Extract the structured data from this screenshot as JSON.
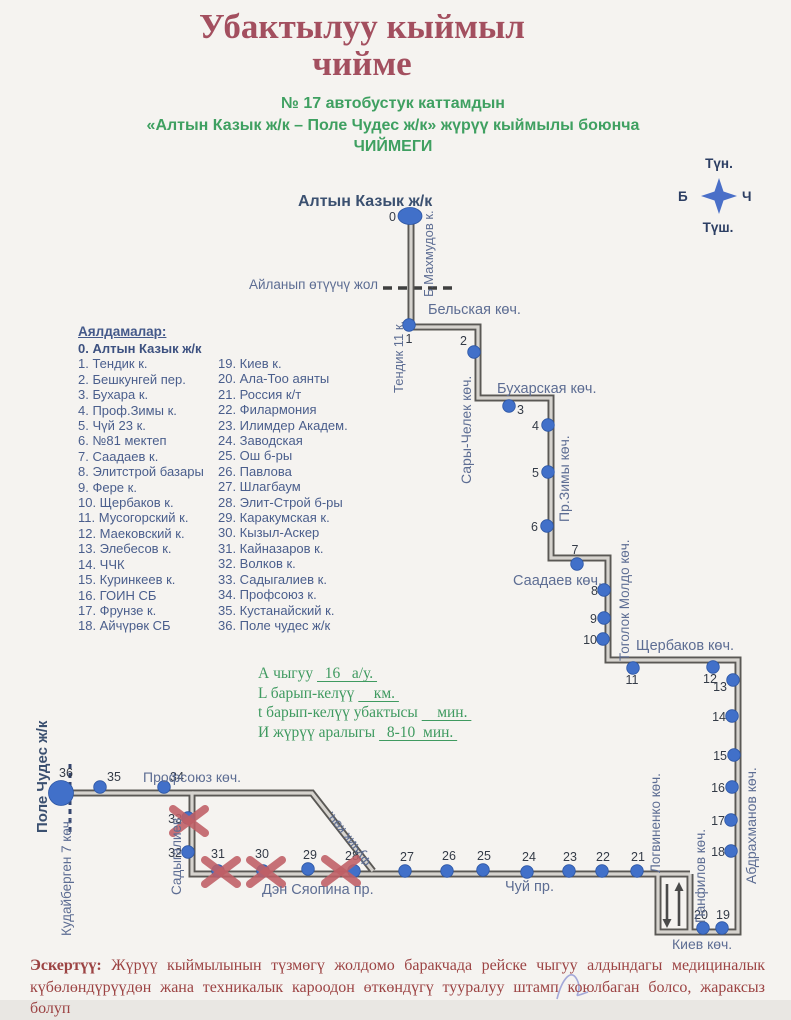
{
  "title": {
    "line1": "Убактылуу кыймыл",
    "line2": "чийме"
  },
  "subtitle": {
    "line1": "№ 17  автобустук каттамдын",
    "line2": "«Алтын Казык ж/к  – Поле Чудес ж/к» жүрүү кыймылы боюнча",
    "line3": "ЧИЙМЕГИ"
  },
  "compass": {
    "north": "Түн.",
    "south": "Түш.",
    "west": "Б",
    "east": "Ч",
    "star_color": "#4a6fc8"
  },
  "legend": {
    "heading": "Аялдамалар:",
    "col1": [
      "0. Алтын Казык ж/к",
      "1. Тендик к.",
      "2. Бешкунгей пер.",
      "3. Бухара к.",
      "4. Проф.Зимы к.",
      "5. Чүй 23 к.",
      "6. №81 мектеп",
      "7. Саадаев к.",
      "8. Элитстрой базары",
      "9. Фере к.",
      "10. Щербаков к.",
      "11. Мусогорский к.",
      "12. Маековский к.",
      "13. Элебесов к.",
      "14. ЧЧК",
      "15. Куринкеев к.",
      "16. ГОИН СБ",
      "17. Фрунзе к.",
      "18. Айчүрөк СБ"
    ],
    "col2": [
      "19. Киев к.",
      "20. Ала-Тоо аянты",
      "21. Россия к/т",
      "22. Филармония",
      "23. Илимдер Академ.",
      "24. Заводская",
      "25. Ош б-ры",
      "26. Павлова",
      "27. Шлагбаум",
      "28. Элит-Строй б-ры",
      "29. Каракумская к.",
      "30. Кызыл-Аскер",
      "31. Кайназаров к.",
      "32. Волков к.",
      "33. Садыгалиев к.",
      "34. Профсоюз к.",
      "35. Кустанайский к.",
      "36. Поле чудес ж/к"
    ]
  },
  "stats": {
    "lines": [
      {
        "parts": [
          {
            "t": "А чыгуу "
          },
          {
            "t": "  16   а/у. ",
            "u": true
          }
        ]
      },
      {
        "parts": [
          {
            "t": "L барып-келүү "
          },
          {
            "t": "    км. ",
            "u": true
          }
        ]
      },
      {
        "parts": [
          {
            "t": "t барып-келүү убактысы "
          },
          {
            "t": "    мин. ",
            "u": true
          }
        ]
      },
      {
        "parts": [
          {
            "t": "И жүрүү аралыгы "
          },
          {
            "t": "  8-10  мин. ",
            "u": true
          }
        ]
      }
    ]
  },
  "note": {
    "label": "Эскертүү:",
    "text": "Жүрүү кыймылынын түзмөгү жолдомо баракчада рейске чыгуу алдындагы медициналык күбөлөндүрүүдөн жана техникалык кароодон өткөндүгү тууралуу штамп коюлбаган болсо, жараксыз болуп"
  },
  "map": {
    "colors": {
      "road_outer": "#5a5855",
      "road_inner": "#d6d3ce",
      "stop": "#4170c9",
      "stop_edge": "#2d56a4",
      "stop_label": "#343b47",
      "street": "#5d6d93",
      "terminal": "#3b5070",
      "xmark": "#c05f66",
      "arrow": "#4a4a4a"
    },
    "roads": [
      {
        "pts": [
          [
            411,
            213
          ],
          [
            411,
            327
          ],
          [
            478,
            327
          ],
          [
            478,
            398
          ],
          [
            551,
            398
          ],
          [
            551,
            558
          ],
          [
            608,
            558
          ],
          [
            608,
            660
          ],
          [
            738,
            660
          ],
          [
            738,
            932
          ],
          [
            658,
            932
          ],
          [
            658,
            874
          ],
          [
            192,
            874
          ],
          [
            192,
            793
          ],
          [
            61,
            793
          ]
        ]
      },
      {
        "pts": [
          [
            192,
            793
          ],
          [
            312,
            793
          ],
          [
            373,
            871
          ]
        ]
      },
      {
        "pts": [
          [
            690,
            874
          ],
          [
            690,
            932
          ]
        ]
      },
      {
        "pts": [
          [
            658,
            874
          ],
          [
            690,
            874
          ]
        ]
      }
    ],
    "dashed": [
      {
        "name": "detour-dashed-line",
        "x1": 383,
        "y1": 288,
        "x2": 452,
        "y2": 288,
        "dash": "9,6",
        "w": 3.5,
        "color": "#3f3f3f"
      },
      {
        "name": "terminal-dashed-line",
        "x1": 70,
        "y1": 764,
        "x2": 70,
        "y2": 834,
        "dash": "5,4",
        "w": 3,
        "color": "#35456e"
      }
    ],
    "arrows": [
      {
        "x": 667,
        "ytail": 884,
        "yhead": 928
      },
      {
        "x": 679,
        "ytail": 926,
        "yhead": 882
      }
    ],
    "streets": [
      {
        "name": "Алтын Казык ж/к",
        "x": 298,
        "y": 206,
        "rot": 0,
        "anchor": "start",
        "bold": true,
        "navy": true,
        "size": 16
      },
      {
        "name": "Б.Махмудов к.",
        "x": 433,
        "y": 297,
        "rot": -90,
        "anchor": "start",
        "size": 13
      },
      {
        "name": "Айланып өтүүчү жол",
        "x": 378,
        "y": 289,
        "rot": 0,
        "anchor": "end",
        "size": 13.5
      },
      {
        "name": "Тендик 11 к.",
        "x": 403,
        "y": 393,
        "rot": -90,
        "anchor": "start",
        "size": 13
      },
      {
        "name": "Бельская көч.",
        "x": 428,
        "y": 314,
        "rot": 0,
        "anchor": "start",
        "size": 14.5
      },
      {
        "name": "Сары-Челек көч.",
        "x": 471,
        "y": 484,
        "rot": -90,
        "anchor": "start",
        "size": 14
      },
      {
        "name": "Бухарская көч.",
        "x": 497,
        "y": 393,
        "rot": 0,
        "anchor": "start",
        "size": 14.5
      },
      {
        "name": "Пр.Зимы көч.",
        "x": 569,
        "y": 522,
        "rot": -90,
        "anchor": "start",
        "size": 14
      },
      {
        "name": "Саадаев көч.",
        "x": 513,
        "y": 585,
        "rot": 0,
        "anchor": "start",
        "size": 14.5
      },
      {
        "name": "Тоголок Молдо көч.",
        "x": 629,
        "y": 661,
        "rot": -90,
        "anchor": "start",
        "size": 13.5
      },
      {
        "name": "Щербаков көч.",
        "x": 636,
        "y": 650,
        "rot": 0,
        "anchor": "start",
        "size": 14.5
      },
      {
        "name": "Абдрахманов көч.",
        "x": 756,
        "y": 884,
        "rot": -90,
        "anchor": "start",
        "size": 14
      },
      {
        "name": "Логвиненко көч.",
        "x": 660,
        "y": 873,
        "rot": -90,
        "anchor": "start",
        "size": 13.5
      },
      {
        "name": "Панфилов көч.",
        "x": 705,
        "y": 923,
        "rot": -90,
        "anchor": "start",
        "size": 13.5
      },
      {
        "name": "Киев көч.",
        "x": 672,
        "y": 949,
        "rot": 0,
        "anchor": "start",
        "size": 14
      },
      {
        "name": "Чуй пр.",
        "x": 505,
        "y": 891,
        "rot": 0,
        "anchor": "start",
        "size": 14.5
      },
      {
        "name": "Дэн Сяопина пр.",
        "x": 262,
        "y": 894,
        "rot": 0,
        "anchor": "start",
        "size": 14.5
      },
      {
        "name": "Фучик көч.",
        "x": 372,
        "y": 862,
        "rot": -128,
        "anchor": "start",
        "size": 13.5
      },
      {
        "name": "Садыгалиев",
        "x": 181,
        "y": 895,
        "rot": -90,
        "anchor": "start",
        "size": 13.5
      },
      {
        "name": "Профсоюз  көч.",
        "x": 143,
        "y": 782,
        "rot": 0,
        "anchor": "start",
        "size": 14
      },
      {
        "name": "Кудайберген 7 көч.",
        "x": 71,
        "y": 936,
        "rot": -90,
        "anchor": "start",
        "size": 13.5
      },
      {
        "name": "Поле Чудес ж/к",
        "x": 47,
        "y": 833,
        "rot": -90,
        "anchor": "start",
        "bold": true,
        "navy": true,
        "size": 15
      }
    ],
    "stops": [
      {
        "n": "0",
        "x": 410,
        "y": 216,
        "big": "ellipse",
        "lx": 396,
        "ly": 221,
        "anchor": "end"
      },
      {
        "n": "1",
        "x": 409,
        "y": 325,
        "lx": 409,
        "ly": 343,
        "anchor": "middle"
      },
      {
        "n": "2",
        "x": 474,
        "y": 352,
        "lx": 467,
        "ly": 345,
        "anchor": "end"
      },
      {
        "n": "3",
        "x": 509,
        "y": 406,
        "lx": 517,
        "ly": 414,
        "anchor": "start"
      },
      {
        "n": "4",
        "x": 548,
        "y": 425,
        "lx": 539,
        "ly": 430,
        "anchor": "end"
      },
      {
        "n": "5",
        "x": 548,
        "y": 472,
        "lx": 539,
        "ly": 477,
        "anchor": "end"
      },
      {
        "n": "6",
        "x": 547,
        "y": 526,
        "lx": 538,
        "ly": 531,
        "anchor": "end"
      },
      {
        "n": "7",
        "x": 577,
        "y": 564,
        "lx": 575,
        "ly": 554,
        "anchor": "middle"
      },
      {
        "n": "8",
        "x": 604,
        "y": 590,
        "lx": 598,
        "ly": 595,
        "anchor": "end"
      },
      {
        "n": "9",
        "x": 604,
        "y": 618,
        "lx": 597,
        "ly": 623,
        "anchor": "end"
      },
      {
        "n": "10",
        "x": 603,
        "y": 639,
        "lx": 597,
        "ly": 644,
        "anchor": "end"
      },
      {
        "n": "11",
        "x": 633,
        "y": 668,
        "lx": 632,
        "ly": 684,
        "anchor": "middle"
      },
      {
        "n": "12",
        "x": 713,
        "y": 667,
        "lx": 710,
        "ly": 683,
        "anchor": "middle"
      },
      {
        "n": "13",
        "x": 733,
        "y": 680,
        "lx": 727,
        "ly": 691,
        "anchor": "end"
      },
      {
        "n": "14",
        "x": 732,
        "y": 716,
        "lx": 726,
        "ly": 721,
        "anchor": "end"
      },
      {
        "n": "15",
        "x": 734,
        "y": 755,
        "lx": 727,
        "ly": 760,
        "anchor": "end"
      },
      {
        "n": "16",
        "x": 732,
        "y": 787,
        "lx": 725,
        "ly": 792,
        "anchor": "end"
      },
      {
        "n": "17",
        "x": 731,
        "y": 820,
        "lx": 725,
        "ly": 825,
        "anchor": "end"
      },
      {
        "n": "18",
        "x": 731,
        "y": 851,
        "lx": 725,
        "ly": 856,
        "anchor": "end"
      },
      {
        "n": "19",
        "x": 722,
        "y": 928,
        "lx": 723,
        "ly": 919,
        "anchor": "middle"
      },
      {
        "n": "20",
        "x": 703,
        "y": 928,
        "lx": 701,
        "ly": 919,
        "anchor": "middle"
      },
      {
        "n": "21",
        "x": 637,
        "y": 871,
        "lx": 638,
        "ly": 861,
        "anchor": "middle"
      },
      {
        "n": "22",
        "x": 602,
        "y": 871,
        "lx": 603,
        "ly": 861,
        "anchor": "middle"
      },
      {
        "n": "23",
        "x": 569,
        "y": 871,
        "lx": 570,
        "ly": 861,
        "anchor": "middle"
      },
      {
        "n": "24",
        "x": 527,
        "y": 872,
        "lx": 529,
        "ly": 861,
        "anchor": "middle"
      },
      {
        "n": "25",
        "x": 483,
        "y": 870,
        "lx": 484,
        "ly": 860,
        "anchor": "middle"
      },
      {
        "n": "26",
        "x": 447,
        "y": 871,
        "lx": 449,
        "ly": 860,
        "anchor": "middle"
      },
      {
        "n": "27",
        "x": 405,
        "y": 871,
        "lx": 407,
        "ly": 861,
        "anchor": "middle"
      },
      {
        "n": "28",
        "x": 354,
        "y": 871,
        "lx": 352,
        "ly": 860,
        "anchor": "middle",
        "xmark": {
          "x": 341,
          "y": 871
        }
      },
      {
        "n": "29",
        "x": 308,
        "y": 869,
        "lx": 310,
        "ly": 859,
        "anchor": "middle"
      },
      {
        "n": "30",
        "x": 263,
        "y": 871,
        "lx": 262,
        "ly": 858,
        "anchor": "middle",
        "xmark": {
          "x": 266,
          "y": 872
        }
      },
      {
        "n": "31",
        "x": 218,
        "y": 871,
        "lx": 218,
        "ly": 858,
        "anchor": "middle",
        "xmark": {
          "x": 221,
          "y": 872
        }
      },
      {
        "n": "32",
        "x": 188,
        "y": 852,
        "lx": 182,
        "ly": 857,
        "anchor": "end"
      },
      {
        "n": "33",
        "x": 188,
        "y": 818,
        "lx": 182,
        "ly": 823,
        "anchor": "end",
        "xmark": {
          "x": 189,
          "y": 821
        }
      },
      {
        "n": "34",
        "x": 164,
        "y": 787,
        "lx": 170,
        "ly": 781,
        "anchor": "start"
      },
      {
        "n": "35",
        "x": 100,
        "y": 787,
        "lx": 107,
        "ly": 781,
        "anchor": "start"
      },
      {
        "n": "36",
        "x": 61,
        "y": 793,
        "big": "circle",
        "lx": 66,
        "ly": 777,
        "anchor": "middle"
      }
    ]
  }
}
